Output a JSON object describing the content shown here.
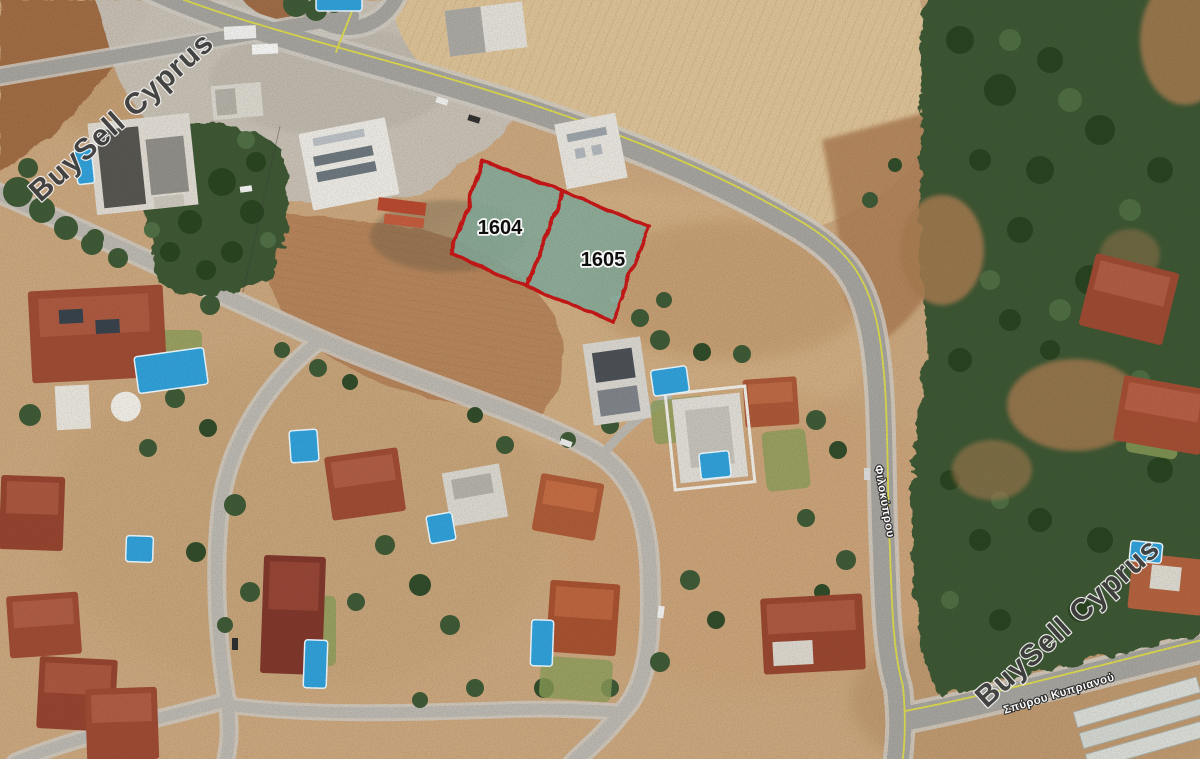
{
  "map": {
    "type": "satellite-property-map",
    "watermark_text": "BuySell Cyprus",
    "plots": [
      {
        "id": "1604"
      },
      {
        "id": "1605"
      }
    ],
    "streets": [
      {
        "name": "Φιλοκύπρου"
      },
      {
        "name": "Σπύρου Κυπριανού"
      }
    ],
    "colors": {
      "plot_outline": "#c31212",
      "plot_fill": "#82a797",
      "watermark_fill": "#3f3f3f",
      "road_centerline": "#d9d64b",
      "street_label": "#ffffff"
    }
  }
}
